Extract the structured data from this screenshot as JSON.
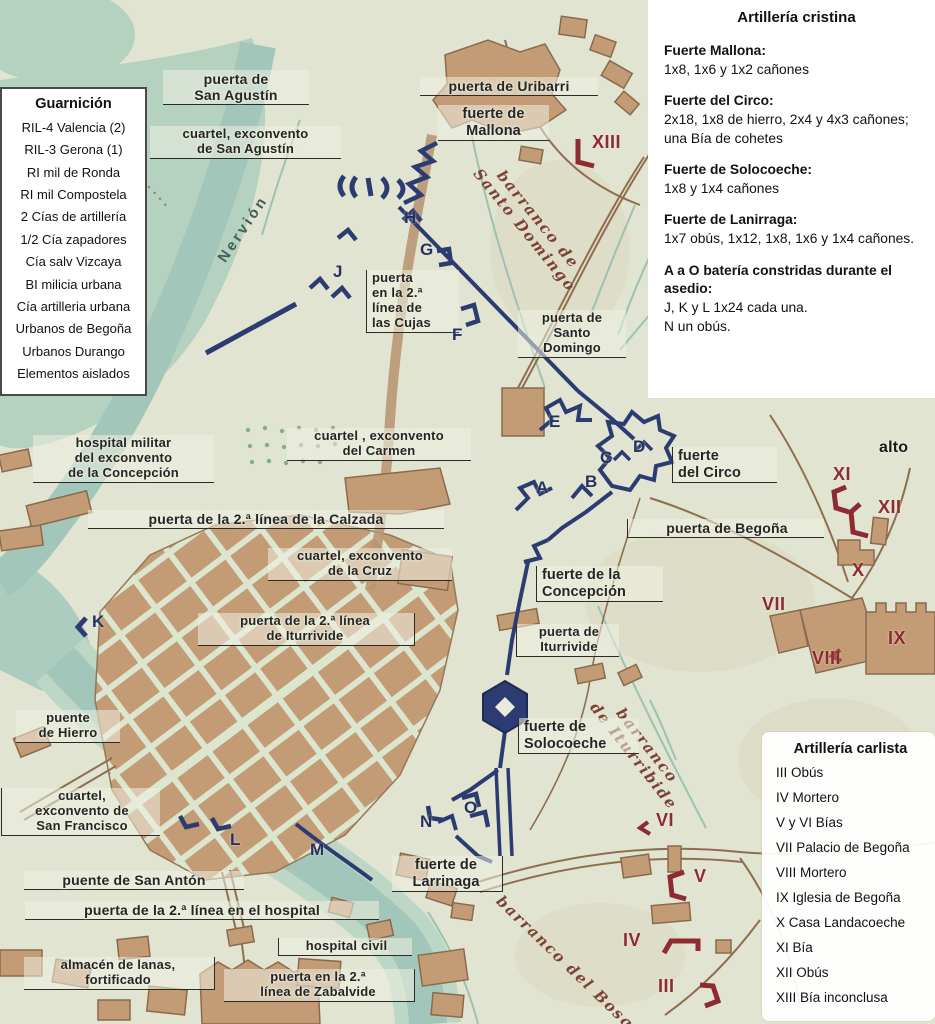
{
  "colors": {
    "paper": "#e1e4d0",
    "vegetation": "#b5d1c0",
    "river": "#a3c6ba",
    "block_tan": "#c39c75",
    "outline_brown": "#8a6a4e",
    "fortification_blue": "#2c3c72",
    "carlist_red": "#8e2a31",
    "script_brown": "#7d4334",
    "ink": "#252525"
  },
  "legend_garrison": {
    "title": "Guarnición",
    "items": [
      "RIL-4 Valencia (2)",
      "RIL-3 Gerona (1)",
      "RI mil de Ronda",
      "RI mil Compostela",
      "2 Cías de artillería",
      "1/2 Cía zapadores",
      "Cía salv Vizcaya",
      "BI milicia urbana",
      "Cía artilleria urbana",
      "Urbanos de Begoña",
      "Urbanos Durango",
      "Elementos aislados"
    ]
  },
  "legend_cristina": {
    "title": "Artillería cristina",
    "entries": [
      {
        "name": "Fuerte Mallona:",
        "desc": "1x8, 1x6 y 1x2 cañones"
      },
      {
        "name": "Fuerte del Circo:",
        "desc": "2x18, 1x8 de hierro,  2x4 y 4x3 cañones; una Bía de cohetes"
      },
      {
        "name": "Fuerte de Solocoeche:",
        "desc": "1x8 y 1x4 cañones"
      },
      {
        "name": "Fuerte de Lanirraga:",
        "desc": "1x7 obús, 1x12, 1x8, 1x6 y 1x4 cañones."
      },
      {
        "name": "A a O batería constridas durante el asedio:",
        "desc": "J, K y L 1x24 cada una.\nN un obús."
      }
    ]
  },
  "legend_carlista": {
    "title": "Artillería carlista",
    "items": [
      "III Obús",
      "IV Mortero",
      "V y VI Bías",
      "VII Palacio de Begoña",
      "VIII Mortero",
      "IX Iglesia de Begoña",
      "X Casa Landacoeche",
      "XI Bía",
      "XII Obús",
      "XIII Bía inconclusa"
    ]
  },
  "map_labels": {
    "puerta_san_agustin": "puerta de\nSan Agustín",
    "cuartel_san_agustin": "cuartel, exconvento\nde San Agustín",
    "puerta_uribarri": "puerta de Uribarri",
    "fuerte_mallona": "fuerte de\nMallona",
    "barranco_santo_domingo": "barranco de\nSanto Domingo",
    "nervion": "Nervión",
    "puerta_cujas": "puerta\nen la 2.ª\nlínea de\nlas Cujas",
    "puerta_santo_domingo": "puerta de\nSanto\nDomingo",
    "hospital_militar": "hospital militar\ndel exconvento\nde la Concepción",
    "cuartel_carmen": "cuartel , exconvento\ndel Carmen",
    "puerta_calzada": "puerta de la 2.ª línea de la Calzada",
    "cuartel_cruz": "cuartel, exconvento\nde la Cruz",
    "fuerte_circo": "fuerte\ndel Circo",
    "puerta_begona": "puerta de Begoña",
    "alto": "alto",
    "puerta_iturrivide_2": "puerta de la 2.ª línea\nde Iturrivide",
    "fuerte_concepcion": "fuerte de la\nConcepción",
    "puerta_iturrivide": "puerta de\nIturrivide",
    "fuerte_solocoeche": "fuerte de\nSolocoeche",
    "barranco_iturribide": "barranco\nde Iturribide",
    "puente_hierro": "puente\nde Hierro",
    "cuartel_san_francisco": "cuartel,\nexconvento de\nSan Francisco",
    "puente_san_anton": "puente de San Antón",
    "puerta_hospital": "puerta de la 2.ª línea en el hospital",
    "almacen_lanas": "almacén de lanas,\nfortificado",
    "hospital_civil": "hospital civil",
    "puerta_zabalvide": "puerta en la 2.ª\nlínea de Zabalvide",
    "fuerte_larrinaga": "fuerte de\nLarrinaga",
    "barranco_bosque": "barranco del Bosque"
  },
  "letters": {
    "A": "A",
    "B": "B",
    "C": "C",
    "D": "D",
    "E": "E",
    "F": "F",
    "G": "G",
    "H": "H",
    "J": "J",
    "K": "K",
    "L": "L",
    "M": "M",
    "N": "N",
    "O": "O"
  },
  "numerals": {
    "III": "III",
    "IV": "IV",
    "V": "V",
    "VI": "VI",
    "VII": "VII",
    "VIII": "VIII",
    "IX": "IX",
    "X": "X",
    "XI": "XI",
    "XII": "XII",
    "XIII": "XIII"
  }
}
